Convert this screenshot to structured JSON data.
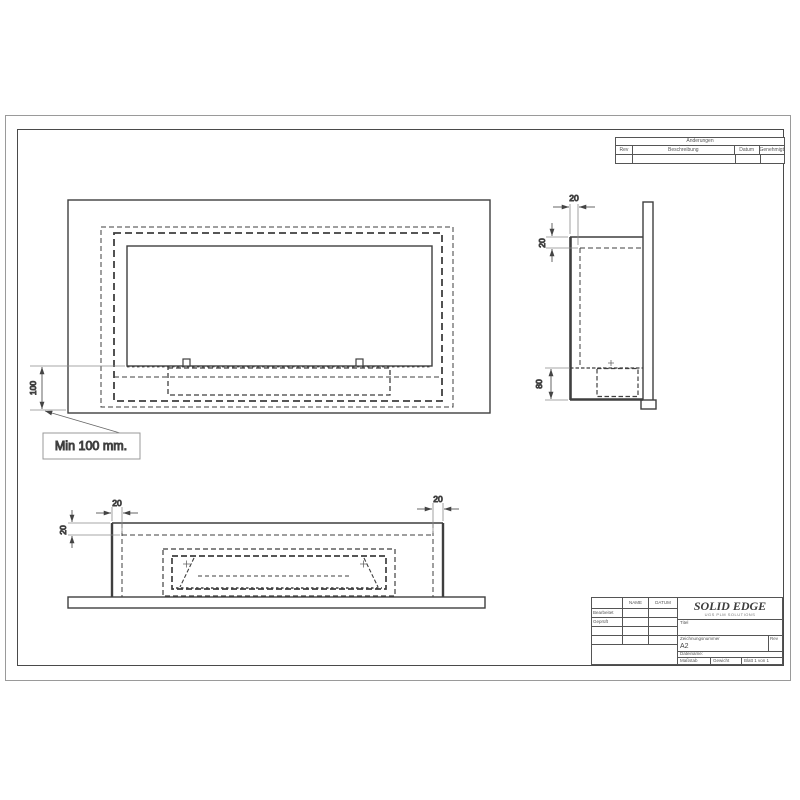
{
  "revision_table": {
    "title": "Änderungen",
    "col_rev": "Rev",
    "col_desc": "Beschreibung",
    "col_date": "Datum",
    "col_approved": "Genehmigt"
  },
  "front_view": {
    "dim_height": "100",
    "note": "Min 100 mm."
  },
  "side_view": {
    "dim_depth_top": "20",
    "dim_flange": "20",
    "dim_burner_depth": "80"
  },
  "bottom_view": {
    "dim_gap_left": "20",
    "dim_flange_left": "20",
    "dim_gap_right": "20"
  },
  "title_block": {
    "logo": "SOLID EDGE",
    "logo_sub": "UGS PLM SOLUTIONS",
    "col_name": "NAME",
    "col_date": "DATUM",
    "row_edited": "Bearbeitet",
    "row_checked": "Geprüft",
    "title_label": "Titel",
    "docnum_label": "Zeichnungsnummer",
    "sheet_size": "A2",
    "rev_label": "Rev",
    "filename_label": "Dateiname:",
    "scale_label": "Maßstab",
    "weight_label": "Gewicht",
    "sheet_label": "Blatt 1 von 1"
  }
}
